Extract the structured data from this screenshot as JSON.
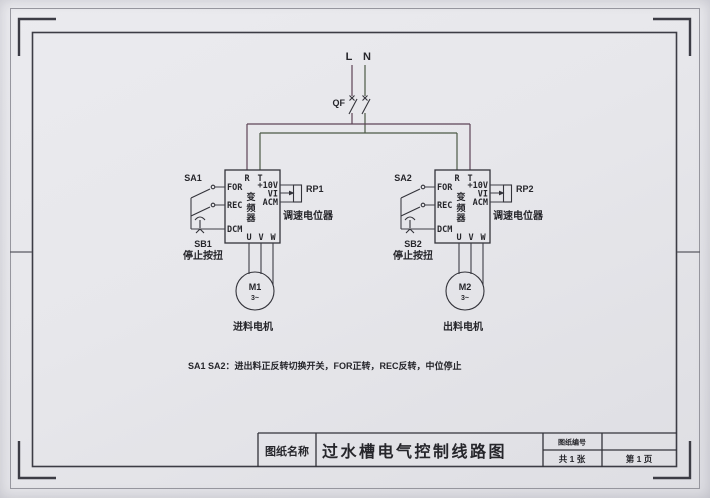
{
  "sheet": {
    "paper_color": "#e8e8ec",
    "line_color": "#3e3e46",
    "l_wire_tint": "#5e4457",
    "n_wire_tint": "#4c5a46"
  },
  "power": {
    "phase_l": "L",
    "phase_n": "N",
    "breaker": "QF"
  },
  "inverters": [
    {
      "selector": "SA1",
      "stop_button": "SB1",
      "stop_caption": "停止按扭",
      "top_terminals": [
        "R",
        "T"
      ],
      "input_terminals": [
        "FOR",
        "REC",
        "DCM"
      ],
      "analog_terminals": [
        "+10V",
        "VI",
        "ACM"
      ],
      "output_terminals": [
        "U",
        "V",
        "W"
      ],
      "device_label": "变频器",
      "pot": "RP1",
      "pot_caption": "调速电位器",
      "motor": "M1",
      "motor_phases": "3~",
      "motor_caption": "进料电机"
    },
    {
      "selector": "SA2",
      "stop_button": "SB2",
      "stop_caption": "停止按扭",
      "top_terminals": [
        "R",
        "T"
      ],
      "input_terminals": [
        "FOR",
        "REC",
        "DCM"
      ],
      "analog_terminals": [
        "+10V",
        "VI",
        "ACM"
      ],
      "output_terminals": [
        "U",
        "V",
        "W"
      ],
      "device_label": "变频器",
      "pot": "RP2",
      "pot_caption": "调速电位器",
      "motor": "M2",
      "motor_phases": "3~",
      "motor_caption": "出料电机"
    }
  ],
  "note": "SA1 SA2：进出料正反转切换开关，FOR正转，REC反转，中位停止",
  "title_block": {
    "name_label": "图纸名称",
    "title": "过水槽电气控制线路图",
    "number_label": "图纸编号",
    "number_value": "",
    "sheet_count": "共 1 张",
    "page_number": "第 1 页"
  }
}
